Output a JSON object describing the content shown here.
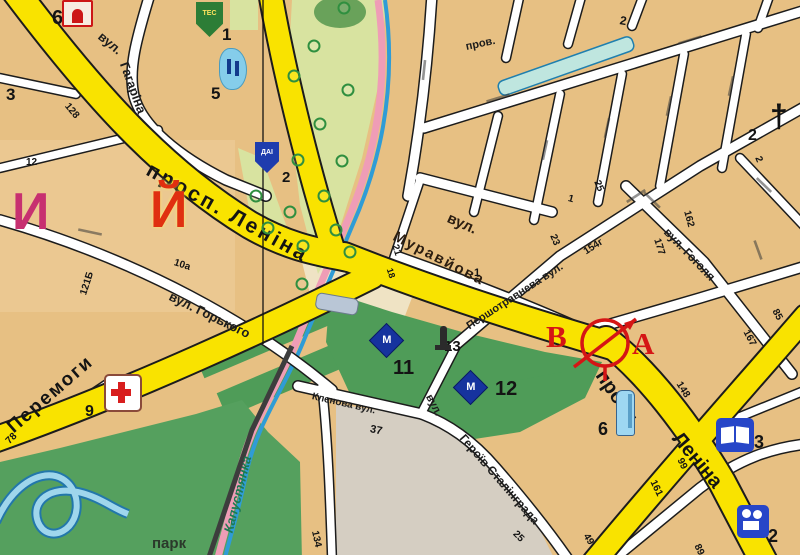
{
  "colors": {
    "tan": "#e7c083",
    "roadYellow": "#f9e300",
    "parkGreen": "#4f9c58",
    "parkLight": "#d8e3a0",
    "water": "#8fd0e8",
    "markerRed": "#d51515",
    "letterPink": "#c73070",
    "letterRed": "#e03010"
  },
  "map": {
    "marker": {
      "from": "В",
      "to": "А"
    },
    "labels": [
      {
        "text": "просп. Леніна",
        "x": 148,
        "y": 158,
        "rot": 29,
        "cls": "major",
        "size": 21,
        "ls": 3,
        "name": "road-label-prosp-lenina-nw"
      },
      {
        "text": "просп.",
        "x": 600,
        "y": 362,
        "rot": 56,
        "cls": "major",
        "size": 20,
        "name": "road-label-prosp"
      },
      {
        "text": "Леніна",
        "x": 676,
        "y": 425,
        "rot": 50,
        "cls": "major",
        "size": 20,
        "name": "road-label-lenina-se"
      },
      {
        "text": "Перемоги",
        "x": 10,
        "y": 420,
        "rot": -41,
        "cls": "major",
        "size": 19,
        "ls": 2,
        "name": "road-label-peremohy"
      },
      {
        "text": "вул.",
        "x": 100,
        "y": 28,
        "rot": 40,
        "cls": "street",
        "size": 13,
        "name": "street-label-vul"
      },
      {
        "text": "Гагаріна",
        "x": 124,
        "y": 56,
        "rot": 70,
        "cls": "street",
        "size": 13,
        "name": "street-label-gagarina"
      },
      {
        "text": "вул. Горького",
        "x": 170,
        "y": 289,
        "rot": 26,
        "cls": "street",
        "size": 13,
        "name": "street-label-gorkogo"
      },
      {
        "text": "вул.",
        "x": 448,
        "y": 210,
        "rot": 24,
        "cls": "street-bold",
        "size": 15,
        "name": "street-label-vul-2"
      },
      {
        "text": "Муравйова",
        "x": 394,
        "y": 228,
        "rot": 27,
        "cls": "street-bold",
        "size": 15,
        "ls": 2,
        "name": "street-label-muravyova"
      },
      {
        "text": "Першотравнева вул.",
        "x": 468,
        "y": 322,
        "rot": -33,
        "cls": "street",
        "size": 11,
        "name": "street-label-pershotravneva"
      },
      {
        "text": "вул. Гоголя",
        "x": 666,
        "y": 224,
        "rot": 46,
        "cls": "street",
        "size": 12,
        "name": "street-label-gogolya"
      },
      {
        "text": "пров.",
        "x": 466,
        "y": 42,
        "rot": -12,
        "cls": "street",
        "size": 11,
        "name": "street-label-prov"
      },
      {
        "text": "вул.",
        "x": 428,
        "y": 390,
        "rot": 62,
        "cls": "street",
        "size": 11,
        "name": "street-label-vul-3"
      },
      {
        "text": "Героїв Сталінграда",
        "x": 462,
        "y": 430,
        "rot": 49,
        "cls": "street",
        "size": 12,
        "name": "street-label-geroiv-stalingrada"
      },
      {
        "text": "Кленова вул.",
        "x": 312,
        "y": 392,
        "rot": 13,
        "cls": "street",
        "size": 10,
        "name": "street-label-klenova"
      },
      {
        "text": "парк",
        "x": 152,
        "y": 536,
        "rot": 0,
        "cls": "park",
        "size": 15,
        "name": "park-label"
      },
      {
        "text": "Капустянка",
        "x": 228,
        "y": 526,
        "rot": -76,
        "cls": "river",
        "size": 13,
        "name": "river-label-kapustyanka"
      },
      {
        "text": "И",
        "x": 12,
        "y": 186,
        "rot": 0,
        "cls": "letter-pink",
        "size": 52,
        "name": "map-letter"
      },
      {
        "text": "Й",
        "x": 150,
        "y": 184,
        "rot": 0,
        "cls": "letter-red",
        "size": 52,
        "name": "map-letter"
      }
    ],
    "house_numbers": [
      {
        "t": "6",
        "x": 52,
        "y": 8,
        "s": 20
      },
      {
        "t": "3",
        "x": 6,
        "y": 86,
        "s": 17
      },
      {
        "t": "1",
        "x": 222,
        "y": 26,
        "s": 17
      },
      {
        "t": "5",
        "x": 211,
        "y": 85,
        "s": 17
      },
      {
        "t": "2",
        "x": 282,
        "y": 170,
        "s": 15
      },
      {
        "t": "12",
        "x": 26,
        "y": 158,
        "s": 10
      },
      {
        "t": "128",
        "x": 66,
        "y": 100,
        "s": 10,
        "r": 50
      },
      {
        "t": "121Б",
        "x": 84,
        "y": 290,
        "s": 10,
        "r": -72
      },
      {
        "t": "10а",
        "x": 174,
        "y": 258,
        "s": 10,
        "r": 18
      },
      {
        "t": "78",
        "x": 8,
        "y": 438,
        "s": 10,
        "r": -45
      },
      {
        "t": "9",
        "x": 85,
        "y": 404,
        "s": 16
      },
      {
        "t": "21",
        "x": 394,
        "y": 240,
        "s": 10,
        "r": 72
      },
      {
        "t": "18",
        "x": 389,
        "y": 264,
        "s": 9,
        "r": 72
      },
      {
        "t": "1",
        "x": 474,
        "y": 268,
        "s": 11
      },
      {
        "t": "23",
        "x": 552,
        "y": 230,
        "s": 10,
        "r": 68
      },
      {
        "t": "25",
        "x": 596,
        "y": 176,
        "s": 10,
        "r": 68
      },
      {
        "t": "1",
        "x": 568,
        "y": 194,
        "s": 10,
        "r": 15
      },
      {
        "t": "2",
        "x": 620,
        "y": 14,
        "s": 12,
        "r": 10
      },
      {
        "t": "2",
        "x": 748,
        "y": 128,
        "s": 16
      },
      {
        "t": "2",
        "x": 757,
        "y": 152,
        "s": 10,
        "r": 68
      },
      {
        "t": "154г",
        "x": 585,
        "y": 248,
        "s": 10,
        "r": -33
      },
      {
        "t": "162",
        "x": 686,
        "y": 206,
        "s": 10,
        "r": 75
      },
      {
        "t": "177",
        "x": 656,
        "y": 234,
        "s": 10,
        "r": 72
      },
      {
        "t": "85",
        "x": 774,
        "y": 305,
        "s": 10,
        "r": 62
      },
      {
        "t": "167",
        "x": 745,
        "y": 326,
        "s": 10,
        "r": 62
      },
      {
        "t": "148",
        "x": 678,
        "y": 378,
        "s": 10,
        "r": 58
      },
      {
        "t": "99",
        "x": 679,
        "y": 454,
        "s": 10,
        "r": 64
      },
      {
        "t": "161",
        "x": 652,
        "y": 476,
        "s": 10,
        "r": 64
      },
      {
        "t": "89",
        "x": 696,
        "y": 540,
        "s": 10,
        "r": 64
      },
      {
        "t": "49",
        "x": 585,
        "y": 530,
        "s": 10,
        "r": 58
      },
      {
        "t": "37",
        "x": 370,
        "y": 424,
        "s": 11,
        "r": 12
      },
      {
        "t": "134",
        "x": 314,
        "y": 526,
        "s": 10,
        "r": 78
      },
      {
        "t": "25",
        "x": 514,
        "y": 528,
        "s": 10,
        "r": 45
      },
      {
        "t": "11",
        "x": 393,
        "y": 358,
        "s": 20
      },
      {
        "t": "12",
        "x": 495,
        "y": 379,
        "s": 20
      },
      {
        "t": "13",
        "x": 444,
        "y": 339,
        "s": 15
      },
      {
        "t": "6",
        "x": 598,
        "y": 420,
        "s": 18
      },
      {
        "t": "3",
        "x": 754,
        "y": 433,
        "s": 18
      },
      {
        "t": "2",
        "x": 768,
        "y": 527,
        "s": 18
      }
    ],
    "icons": [
      {
        "type": "redBuilding",
        "x": 62,
        "y": 0
      },
      {
        "type": "greenShield",
        "x": 196,
        "y": 2,
        "label": "ТЕС"
      },
      {
        "type": "blueMonument",
        "x": 219,
        "y": 48
      },
      {
        "type": "daiShield",
        "x": 255,
        "y": 142,
        "label": "ДАІ"
      },
      {
        "type": "hospital",
        "x": 104,
        "y": 374
      },
      {
        "type": "museum",
        "x": 374,
        "y": 328,
        "label": "М"
      },
      {
        "type": "museum",
        "x": 458,
        "y": 375,
        "label": "М"
      },
      {
        "type": "statue",
        "x": 434,
        "y": 326
      },
      {
        "type": "church",
        "x": 770,
        "y": 98,
        "label": "†"
      },
      {
        "type": "book",
        "x": 716,
        "y": 418
      },
      {
        "type": "cinema",
        "x": 737,
        "y": 505
      },
      {
        "type": "obelisk",
        "x": 616,
        "y": 390
      }
    ],
    "trees": [
      [
        344,
        8
      ],
      [
        314,
        46
      ],
      [
        348,
        90
      ],
      [
        294,
        76
      ],
      [
        320,
        124
      ],
      [
        342,
        161
      ],
      [
        298,
        160
      ],
      [
        324,
        196
      ],
      [
        290,
        212
      ],
      [
        336,
        230
      ],
      [
        303,
        246
      ],
      [
        256,
        196
      ],
      [
        268,
        228
      ],
      [
        350,
        252
      ],
      [
        302,
        284
      ]
    ]
  }
}
